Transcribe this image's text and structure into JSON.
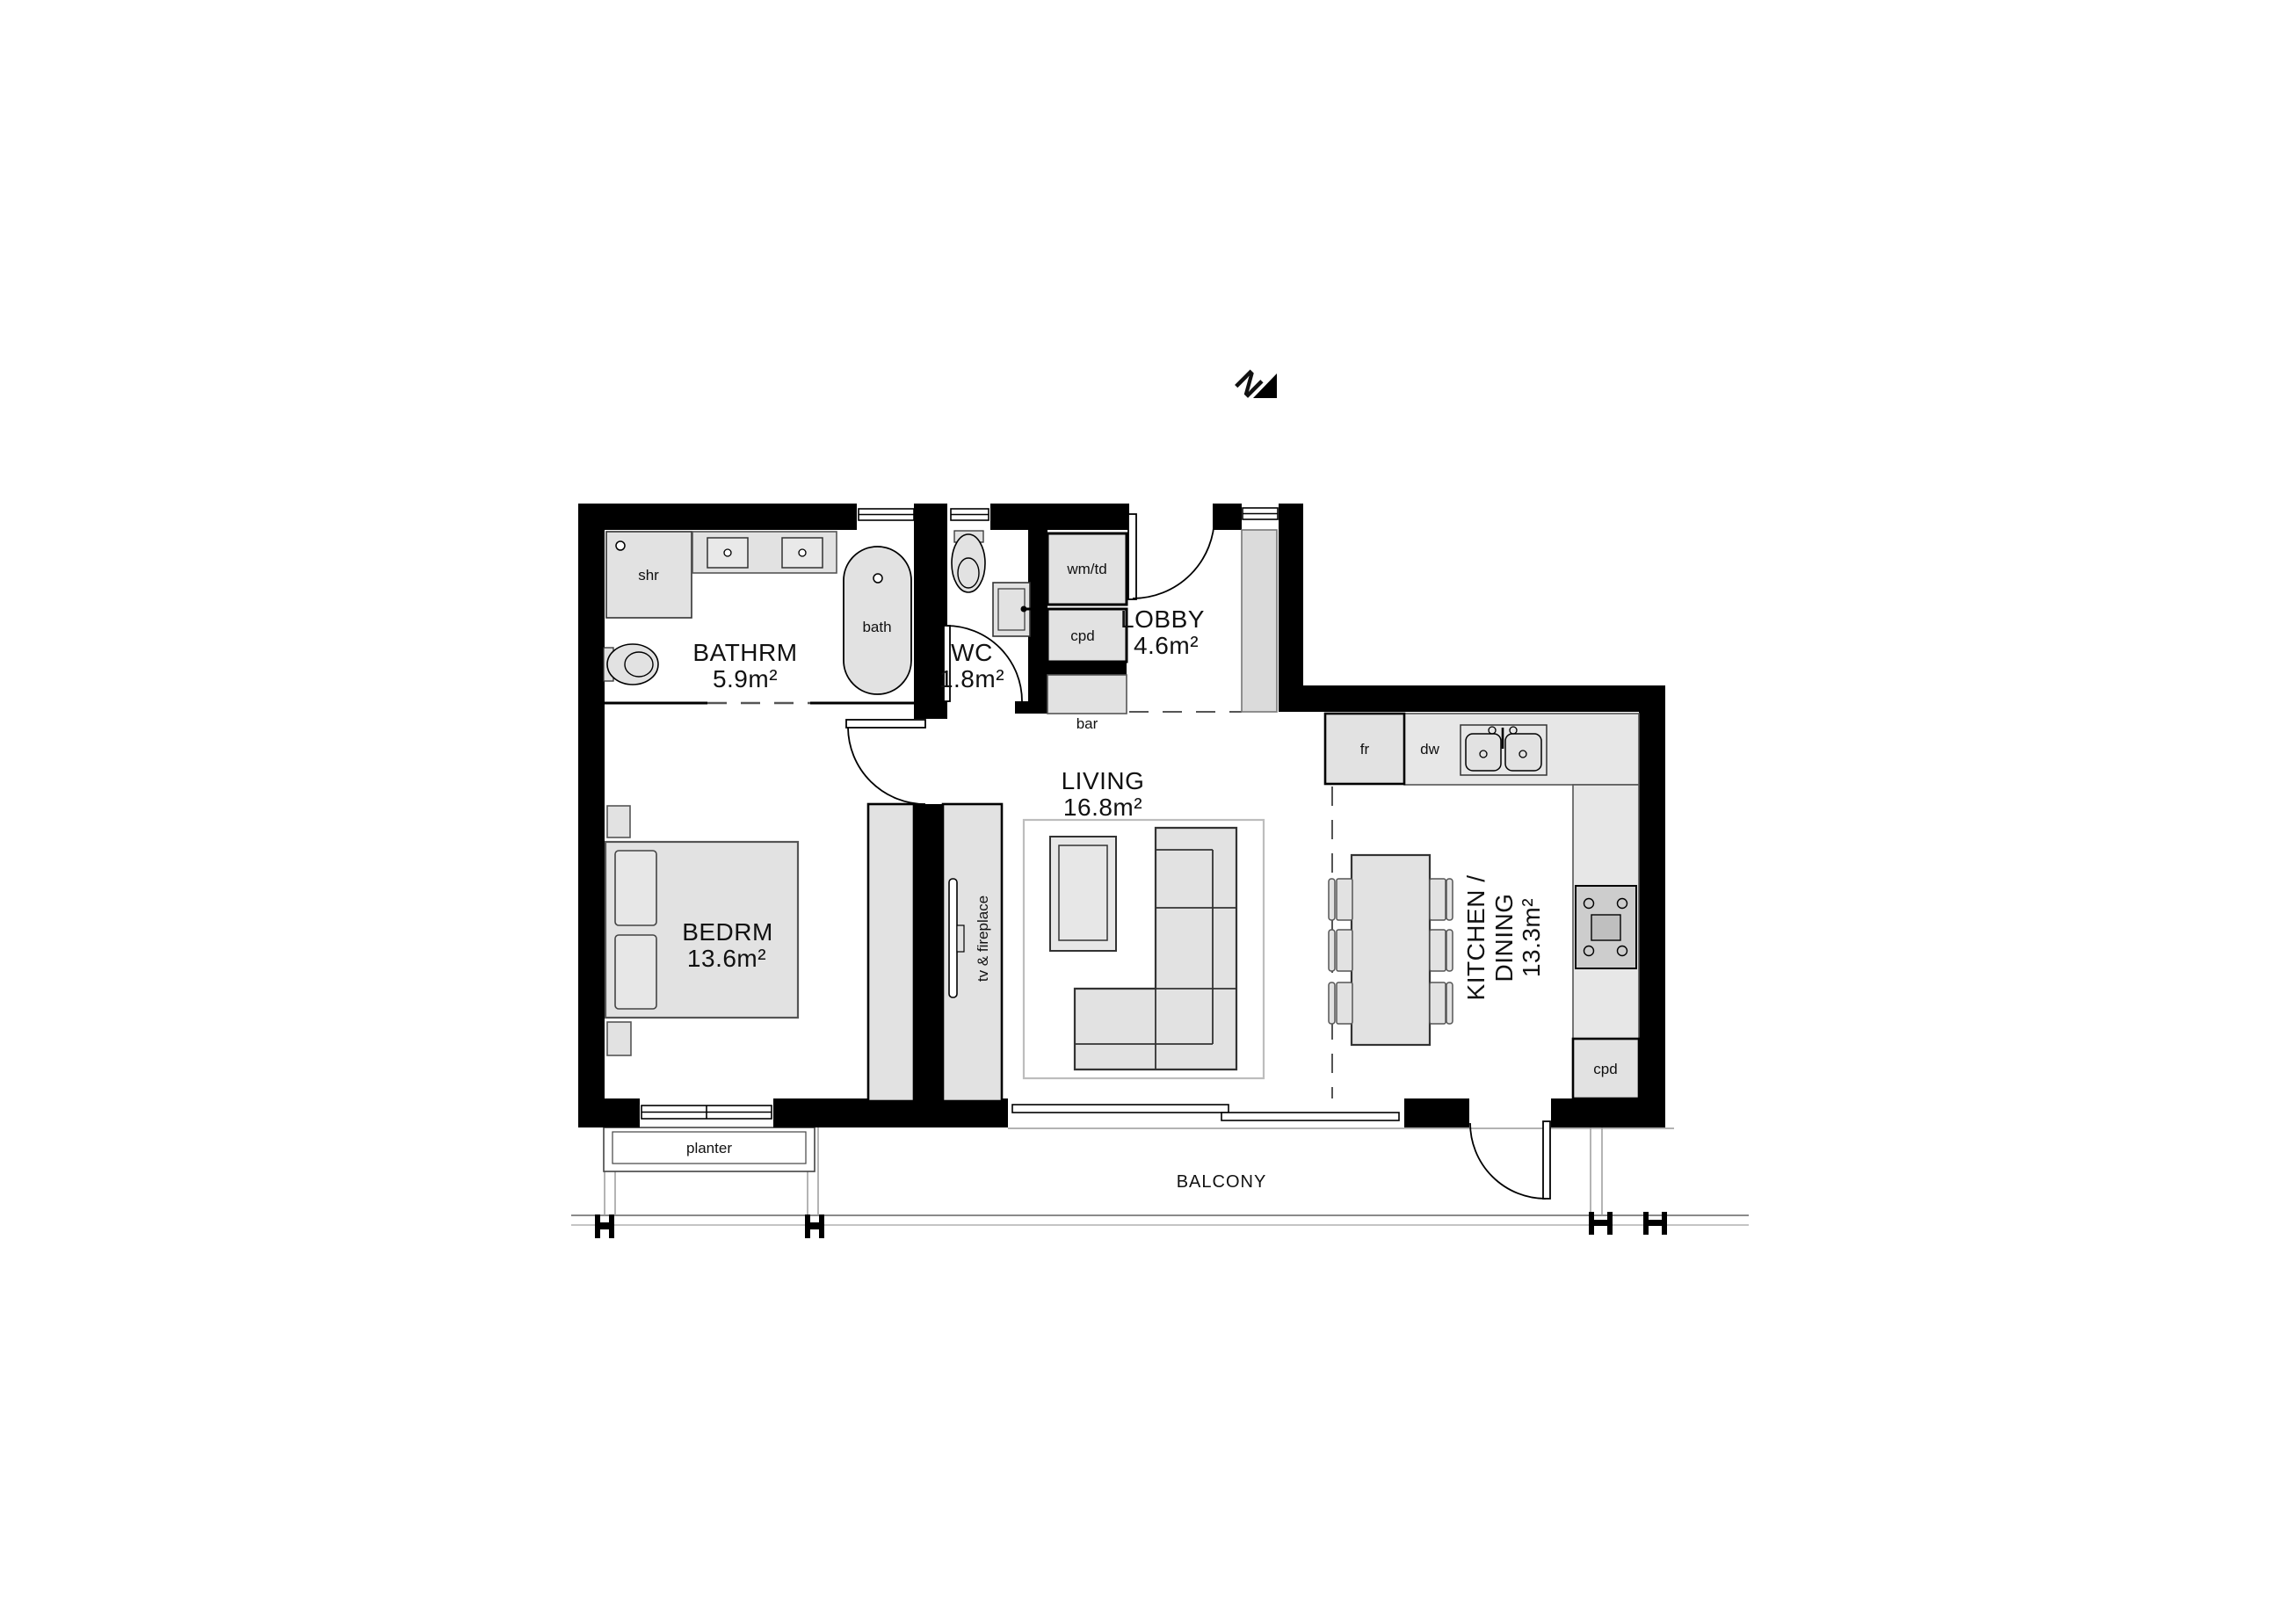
{
  "north_indicator": {
    "label": "N"
  },
  "rooms": [
    {
      "name": "BATHRM",
      "area": "5.9m²"
    },
    {
      "name": "WC",
      "area": "1.8m²"
    },
    {
      "name": "LOBBY",
      "area": "4.6m²"
    },
    {
      "name": "LIVING",
      "area": "16.8m²"
    },
    {
      "name": "BEDRM",
      "area": "13.6m²"
    },
    {
      "name_line1": "KITCHEN /",
      "name_line2": "DINING",
      "area": "13.3m²"
    }
  ],
  "fixtures": {
    "shower": "shr",
    "bath": "bath",
    "washer_dryer": "wm/td",
    "lobby_cupboard": "cpd",
    "bar": "bar",
    "fridge": "fr",
    "dishwasher": "dw",
    "kitchen_cupboard": "cpd",
    "planter": "planter",
    "tv_fireplace": "tv & fireplace",
    "balcony": "BALCONY"
  }
}
